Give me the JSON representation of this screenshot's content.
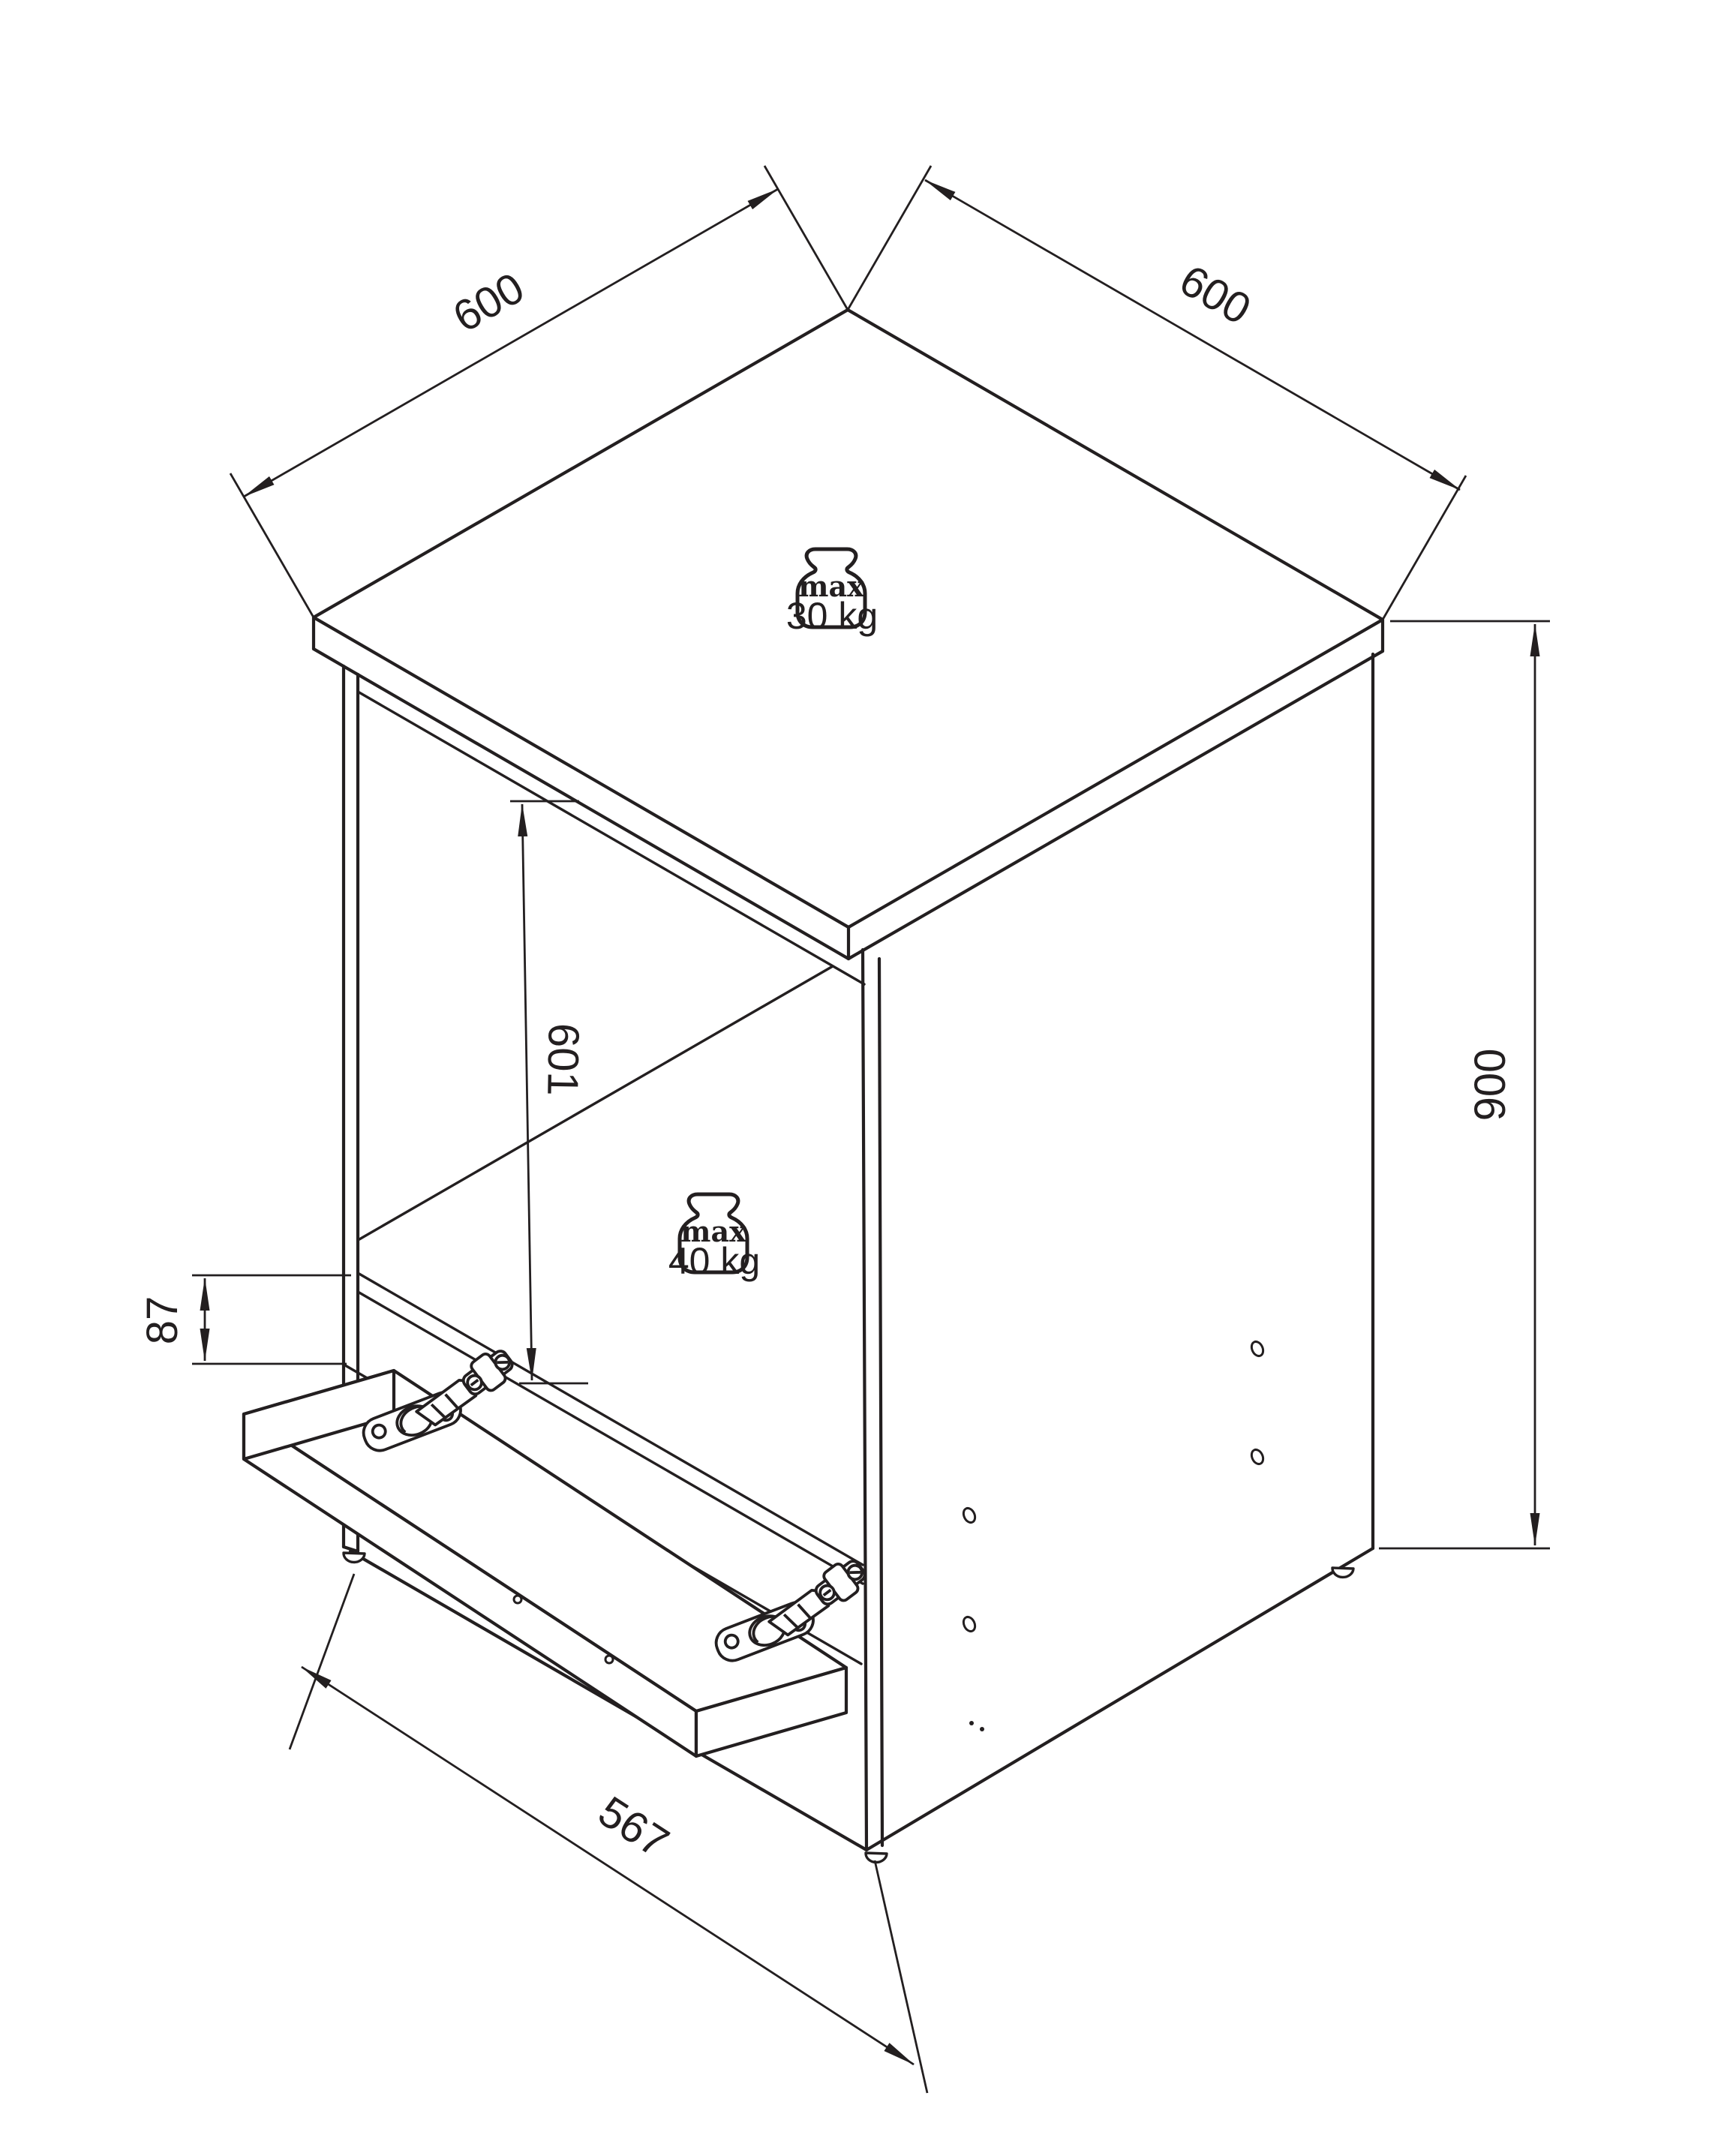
{
  "drawing": {
    "type": "isometric-furniture-assembly-diagram",
    "line_color": "#231f20",
    "background": "#ffffff",
    "dims": {
      "top_left_width": "600",
      "top_right_depth": "600",
      "height": "900",
      "niche_height": "601",
      "front_lip": "87",
      "door_width": "567"
    },
    "weights": {
      "top": {
        "label": "max",
        "value": "30 kg"
      },
      "shelf": {
        "label": "max",
        "value": "40 kg"
      }
    }
  }
}
